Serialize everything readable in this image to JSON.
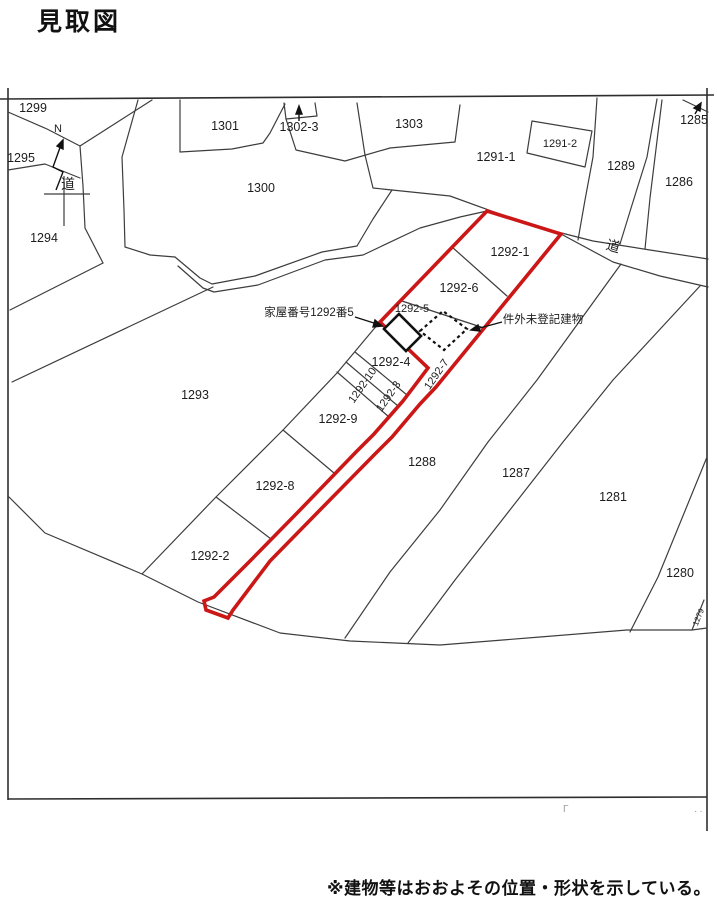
{
  "title": "見取図",
  "footnote": "※建物等はおおよその位置・形状を示している。",
  "colors": {
    "highlight_red": "#cc1717",
    "line": "#3d3d3d",
    "text": "#1c1c1c"
  },
  "compass": {
    "north": "N"
  },
  "roads": {
    "northwest": "道",
    "northeast": "道"
  },
  "annotations": {
    "house_number_label": "家屋番号1292番5",
    "unregistered_building_label": "件外未登記建物"
  },
  "corner_marks": {
    "left": "Γ",
    "right": "··"
  },
  "parcels": {
    "p1299": "1299",
    "p1295": "1295",
    "p1294": "1294",
    "p1293": "1293",
    "p1300": "1300",
    "p1301": "1301",
    "p1302_3": "1302-3",
    "p1303": "1303",
    "p1291_1": "1291-1",
    "p1291_2": "1291-2",
    "p1289": "1289",
    "p1285": "1285",
    "p1286": "1286",
    "p1292_1": "1292-1",
    "p1292_6": "1292-6",
    "p1292_5": "1292-5",
    "p1292_4": "1292-4",
    "p1292_7": "1292-7",
    "p1292_10": "1292-10",
    "p1292_3": "1292-3",
    "p1292_9": "1292-9",
    "p1292_8": "1292-8",
    "p1292_2": "1292-2",
    "p1288": "1288",
    "p1287": "1287",
    "p1281": "1281",
    "p1280": "1280",
    "p1279": "1279"
  }
}
